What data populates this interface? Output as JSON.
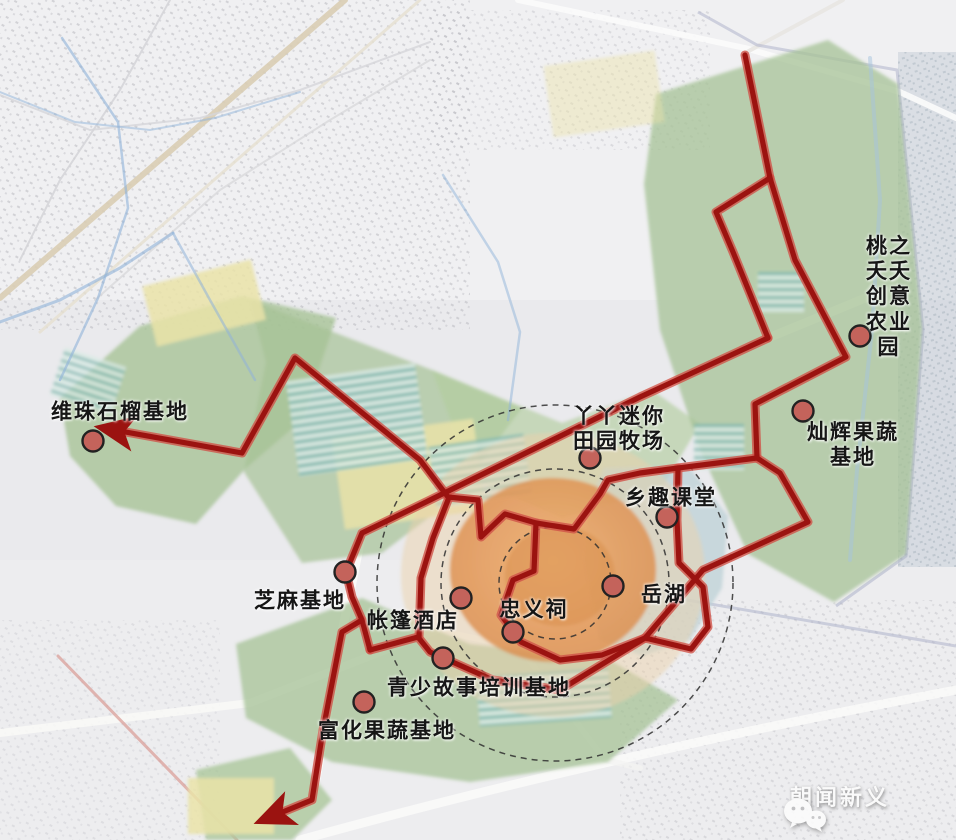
{
  "map": {
    "description": "tourism-planning map with red visiting route over satellite basemap",
    "locations": [
      {
        "id": "weizhu",
        "label": "维珠石榴基地",
        "label_x": 120,
        "label_y": 412,
        "dot_x": 93,
        "dot_y": 441
      },
      {
        "id": "taozhi",
        "label": "桃之夭夭\n创意农业园",
        "label_x": 889,
        "label_y": 297,
        "dot_x": 860,
        "dot_y": 336
      },
      {
        "id": "canhui",
        "label": "灿辉果蔬基地",
        "label_x": 853,
        "label_y": 445,
        "dot_x": 803,
        "dot_y": 411
      },
      {
        "id": "yaya",
        "label": "丫丫迷你\n田园牧场",
        "label_x": 619,
        "label_y": 429,
        "dot_x": 590,
        "dot_y": 458
      },
      {
        "id": "xiangqu",
        "label": "乡趣课堂",
        "label_x": 671,
        "label_y": 498,
        "dot_x": 667,
        "dot_y": 517
      },
      {
        "id": "yuehu",
        "label": "岳湖",
        "label_x": 664,
        "label_y": 595,
        "dot_x": 613,
        "dot_y": 586
      },
      {
        "id": "zhongyi",
        "label": "忠义祠",
        "label_x": 534,
        "label_y": 610,
        "dot_x": 513,
        "dot_y": 632
      },
      {
        "id": "zhangpeng",
        "label": "帐篷酒店",
        "label_x": 413,
        "label_y": 621,
        "dot_x": 461,
        "dot_y": 598
      },
      {
        "id": "zhima",
        "label": "芝麻基地",
        "label_x": 300,
        "label_y": 601,
        "dot_x": 345,
        "dot_y": 572
      },
      {
        "id": "qingshao",
        "label": "青少故事培训基地",
        "label_x": 479,
        "label_y": 688,
        "dot_x": 443,
        "dot_y": 658
      },
      {
        "id": "fuhua",
        "label": "富化果蔬基地",
        "label_x": 387,
        "label_y": 731,
        "dot_x": 364,
        "dot_y": 702
      }
    ],
    "route": {
      "color": "#9b1310",
      "casing_color": "#cf5348",
      "polylines": [
        {
          "points": [
            [
              745,
              55
            ],
            [
              770,
              178
            ]
          ],
          "arrow": false
        },
        {
          "points": [
            [
              770,
              178
            ],
            [
              716,
              212
            ],
            [
              733,
              252
            ],
            [
              768,
              338
            ]
          ],
          "arrow": false
        },
        {
          "points": [
            [
              768,
              338
            ],
            [
              640,
              397
            ],
            [
              430,
              500
            ],
            [
              362,
              533
            ],
            [
              346,
              572
            ],
            [
              352,
              597
            ],
            [
              362,
              620
            ],
            [
              370,
              650
            ]
          ],
          "arrow": false
        },
        {
          "points": [
            [
              770,
              178
            ],
            [
              795,
              260
            ],
            [
              846,
              357
            ],
            [
              755,
              404
            ],
            [
              757,
              458
            ]
          ],
          "arrow": false
        },
        {
          "points": [
            [
              757,
              458
            ],
            [
              780,
              473
            ],
            [
              808,
              522
            ],
            [
              703,
              570
            ],
            [
              645,
              638
            ]
          ],
          "arrow": false
        },
        {
          "points": [
            [
              757,
              458
            ],
            [
              678,
              468
            ],
            [
              640,
              473
            ],
            [
              608,
              480
            ],
            [
              600,
              494
            ],
            [
              574,
              529
            ],
            [
              536,
              523
            ]
          ],
          "arrow": false
        },
        {
          "points": [
            [
              678,
              468
            ],
            [
              677,
              520
            ],
            [
              679,
              563
            ],
            [
              703,
              587
            ],
            [
              708,
              627
            ],
            [
              691,
              649
            ],
            [
              645,
              638
            ]
          ],
          "arrow": false
        },
        {
          "points": [
            [
              645,
              638
            ],
            [
              560,
              690
            ],
            [
              493,
              680
            ],
            [
              430,
              652
            ],
            [
              418,
              637
            ],
            [
              370,
              650
            ]
          ],
          "arrow": false
        },
        {
          "points": [
            [
              362,
              620
            ],
            [
              342,
              632
            ],
            [
              323,
              730
            ],
            [
              312,
              800
            ],
            [
              268,
              818
            ]
          ],
          "arrow": true
        },
        {
          "points": [
            [
              448,
              497
            ],
            [
              420,
              460
            ],
            [
              295,
              358
            ],
            [
              242,
              453
            ],
            [
              109,
              429
            ]
          ],
          "arrow": true
        },
        {
          "points": [
            [
              448,
              497
            ],
            [
              478,
              500
            ],
            [
              481,
              537
            ],
            [
              505,
              514
            ],
            [
              536,
              523
            ],
            [
              534,
              571
            ],
            [
              513,
              580
            ],
            [
              501,
              615
            ],
            [
              521,
              642
            ],
            [
              560,
              660
            ],
            [
              602,
              655
            ],
            [
              645,
              638
            ]
          ],
          "arrow": false
        },
        {
          "points": [
            [
              419,
              637
            ],
            [
              421,
              578
            ],
            [
              433,
              538
            ],
            [
              448,
              500
            ]
          ],
          "arrow": false
        }
      ]
    },
    "center_rings": {
      "cx": 555,
      "cy": 583,
      "radii": [
        178,
        114,
        56
      ],
      "style": "dashed"
    },
    "watermark": {
      "text": "朝闻新义",
      "icon": "wechat-icon"
    },
    "colors": {
      "route": "#9b1310",
      "route_casing": "#cf5348",
      "marker_fill": "#c4635b",
      "marker_stroke": "#222222",
      "green_area": "#a5c295",
      "yellow_field": "#eae3a8",
      "teal_stripe": "#79b4ac",
      "orange_core": "#e09a58",
      "lake": "#bcd0d6",
      "basemap": "#eaeaed"
    }
  }
}
